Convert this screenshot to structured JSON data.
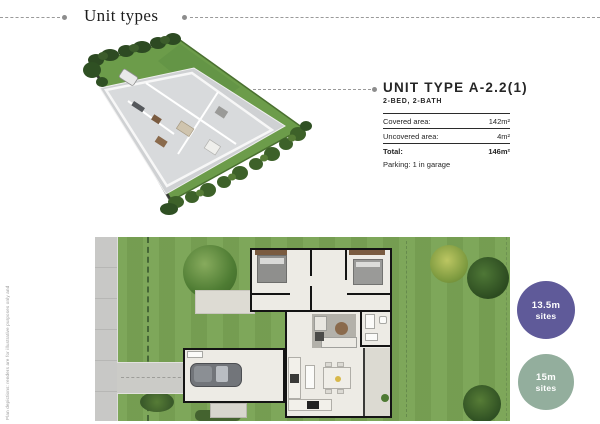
{
  "page": {
    "title": "Unit types",
    "disclaimer": "Plan depictions: renders are for illustrative purposes only and subject to change without notice."
  },
  "unit_panel": {
    "title": "UNIT TYPE A-2.2(1)",
    "subtitle": "2-BED, 2-BATH",
    "rows": [
      {
        "label": "Covered area:",
        "value": "142m²"
      },
      {
        "label": "Uncovered area:",
        "value": "4m²"
      }
    ],
    "total": {
      "label": "Total:",
      "value": "146m²"
    },
    "parking": "Parking: 1 in garage"
  },
  "site_badges": [
    {
      "label": "13.5m",
      "sublabel": "sites",
      "color": "#5f5a99"
    },
    {
      "label": "15m",
      "sublabel": "sites",
      "color": "#93ae9d"
    }
  ],
  "colors": {
    "accent_purple": "#5f5a99",
    "accent_green": "#93ae9d",
    "grass": "#7aa455",
    "dash_line": "#9a9a9a",
    "wall": "#141414"
  }
}
